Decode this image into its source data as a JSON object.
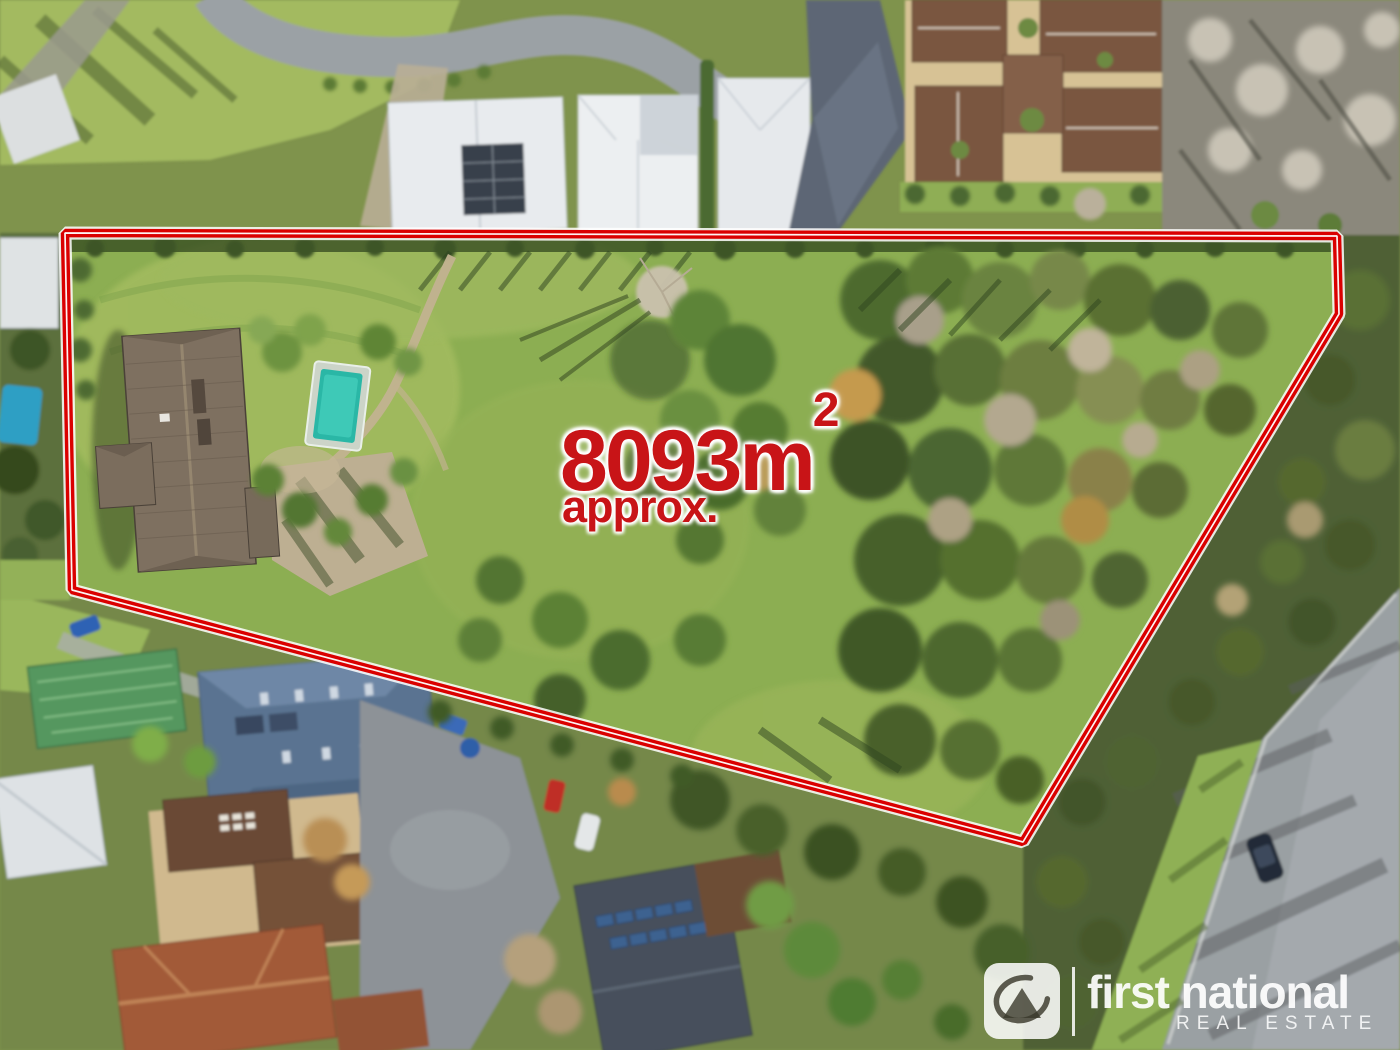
{
  "annotation": {
    "area_value": "8093m",
    "area_exponent": "2",
    "approx_text": "approx.",
    "text_color": "#c81417",
    "boundary_color": "#da0000"
  },
  "logo": {
    "brand": "first national",
    "tagline": "REAL ESTATE",
    "icon_name": "first-national-emblem-icon",
    "text_color": "#ffffff"
  }
}
